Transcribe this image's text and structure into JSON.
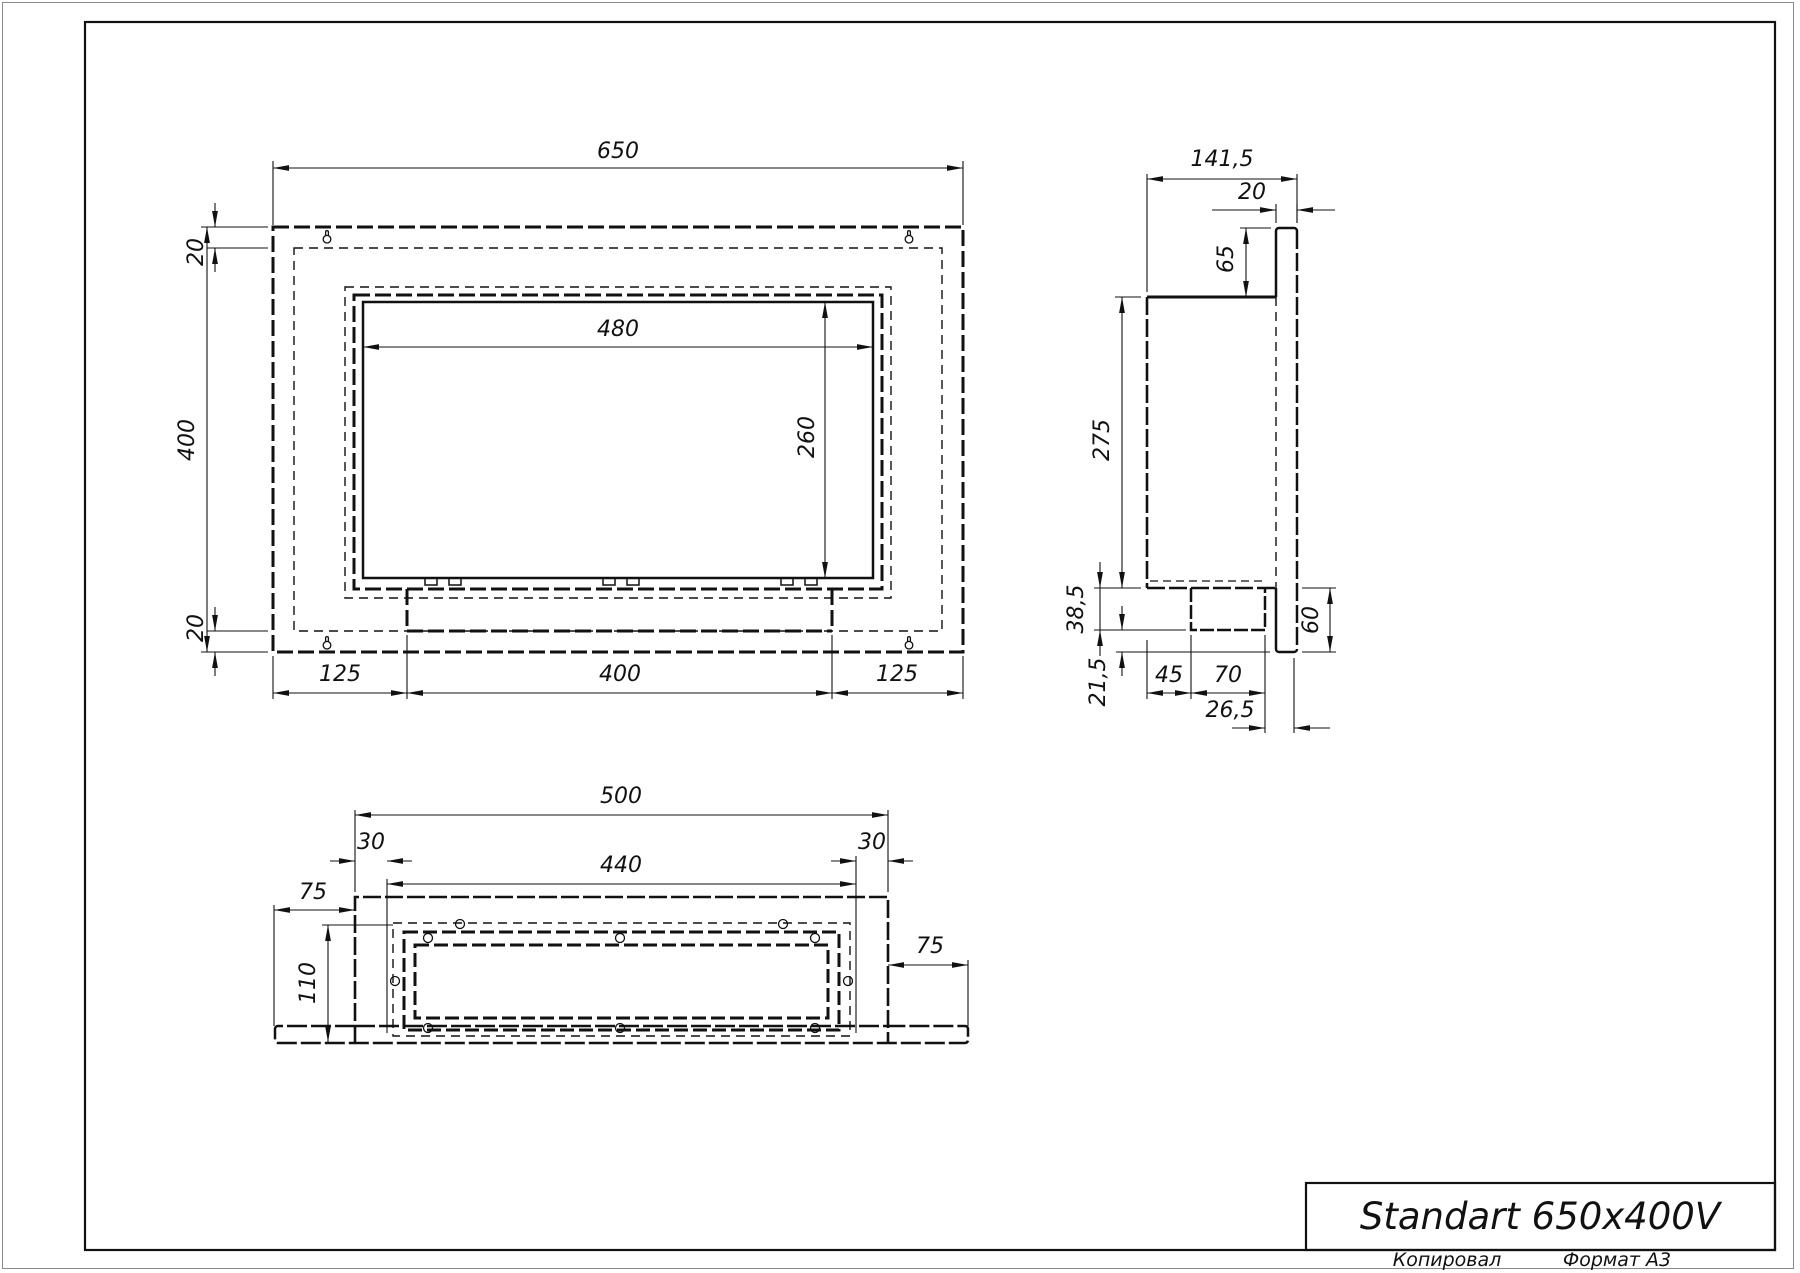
{
  "title_block": {
    "product_name": "Standart 650x400V"
  },
  "footer": {
    "copied_label": "Копировал",
    "format_label": "Формат А3"
  },
  "dims": {
    "front": {
      "width": "650",
      "height": "400",
      "opening_width": "480",
      "opening_height": "260",
      "top_offset": "20",
      "bottom_offset": "20",
      "left_margin": "125",
      "burner_width": "400",
      "right_margin": "125"
    },
    "side": {
      "depth": "141,5",
      "flange_thickness": "20",
      "flange_top": "65",
      "body_height": "275",
      "lower_a": "38,5",
      "lower_b": "21,5",
      "foot_a": "45",
      "foot_b": "70",
      "foot_c": "26,5",
      "flange_bottom": "60"
    },
    "bottom": {
      "body_width": "500",
      "left_inset": "30",
      "window_width": "440",
      "right_inset": "30",
      "left_flange": "75",
      "right_flange": "75",
      "depth": "110"
    }
  },
  "icons": {
    "keyhole": "keyhole mounting slot",
    "hole": "screw hole"
  }
}
